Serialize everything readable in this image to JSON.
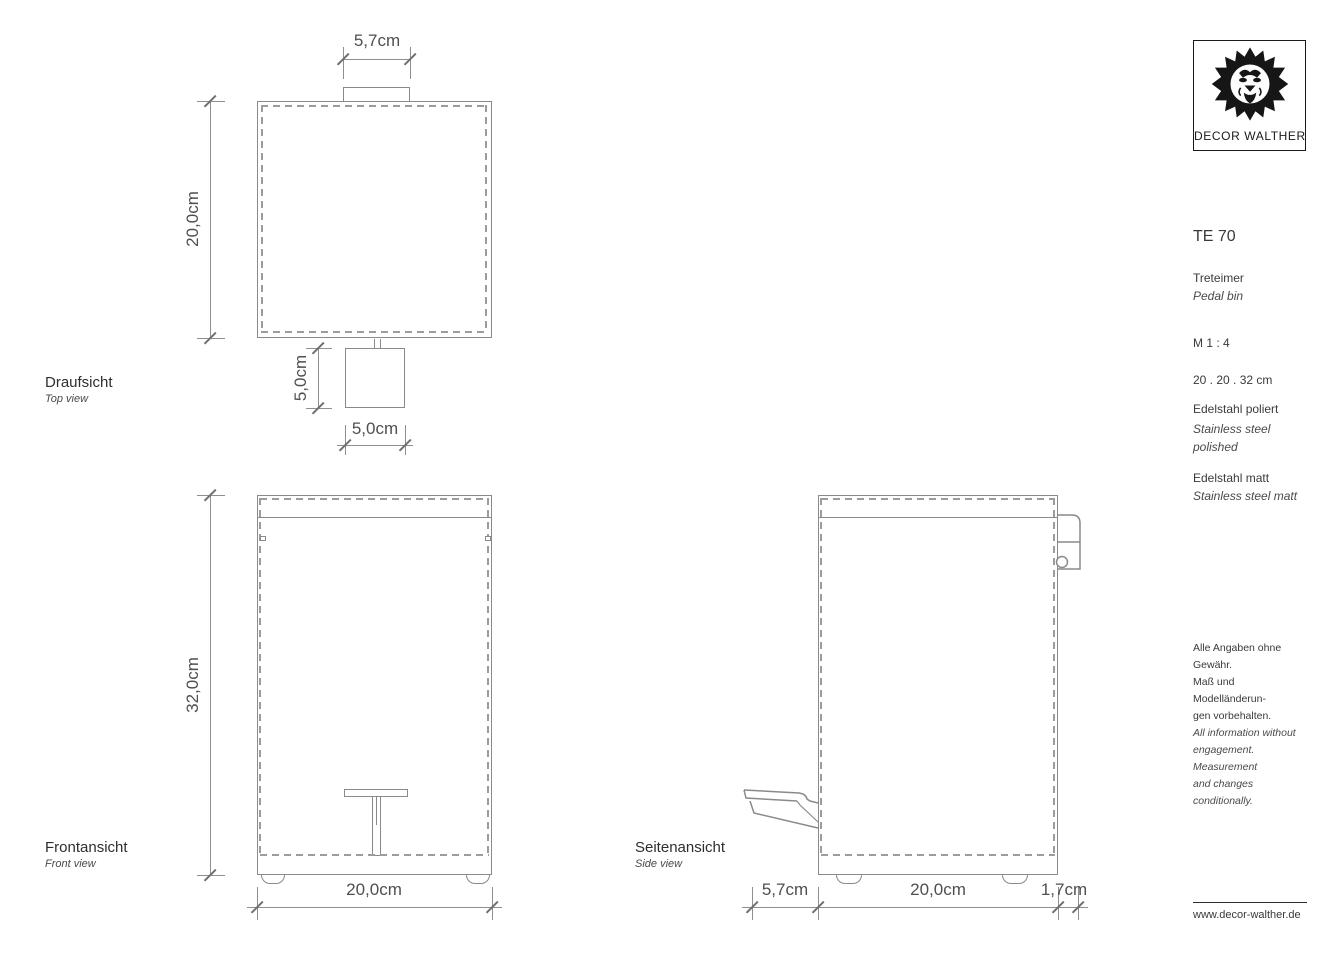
{
  "brand": {
    "logo_icon": "lion-icon",
    "logo_text": "DECOR WALTHER",
    "website": "www.decor-walther.de"
  },
  "product": {
    "model": "TE 70",
    "name_de": "Treteimer",
    "name_en": "Pedal bin",
    "scale": "M 1 : 4",
    "size": "20 . 20 . 32 cm",
    "material1_de": "Edelstahl poliert",
    "material1_en": "Stainless steel polished",
    "material2_de": "Edelstahl matt",
    "material2_en": "Stainless steel matt"
  },
  "views": {
    "top": {
      "label_de": "Draufsicht",
      "label_en": "Top view",
      "dim_tab_width": "5,7cm",
      "dim_depth": "20,0cm",
      "dim_pedal_depth": "5,0cm",
      "dim_pedal_width": "5,0cm"
    },
    "front": {
      "label_de": "Frontansicht",
      "label_en": "Front view",
      "dim_height": "32,0cm",
      "dim_width": "20,0cm"
    },
    "side": {
      "label_de": "Seitenansicht",
      "label_en": "Side view",
      "dim_pedal": "5,7cm",
      "dim_depth": "20,0cm",
      "dim_handle": "1,7cm"
    }
  },
  "disclaimer": {
    "de_lines": [
      "Alle Angaben ohne Gewähr.",
      "Maß und Modelländerun-",
      "gen vorbehalten."
    ],
    "en_lines": [
      "All information without",
      "engagement. Measurement",
      "and changes conditionally."
    ]
  },
  "colors": {
    "line": "#8a8a8a",
    "dash": "#9c9c9c",
    "text": "#3a3a3a",
    "dim_text": "#4f4f4f"
  }
}
